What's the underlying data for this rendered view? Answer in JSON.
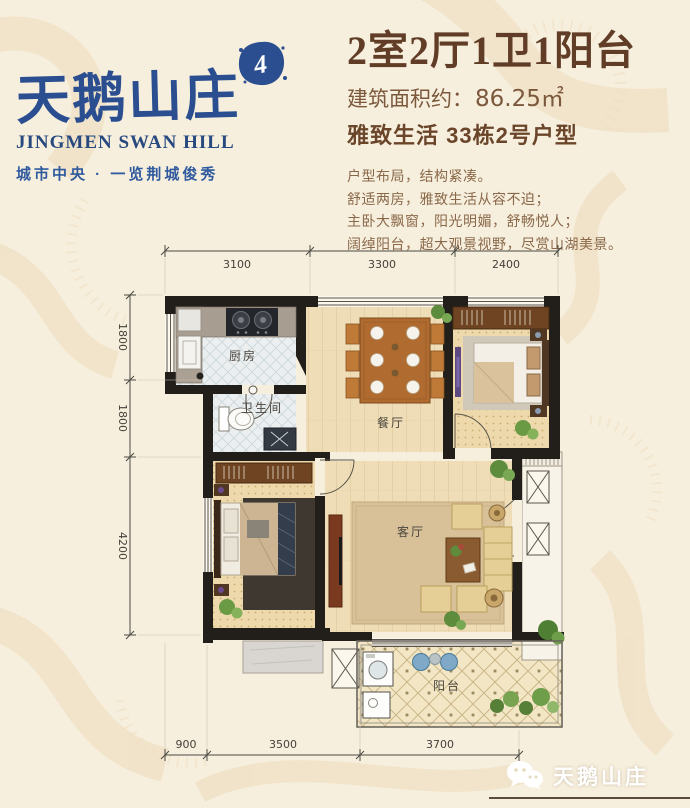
{
  "logo": {
    "brand": "天鹅山庄",
    "subtitle": "JINGMEN SWAN HILL",
    "tagline": "城市中央 · 一览荆城俊秀",
    "badge": "4"
  },
  "header": {
    "title": "2室2厅1卫1阳台",
    "area_label": "建筑面积约：",
    "area_value": "86.25㎡",
    "unit_line": "雅致生活  33栋2号户型",
    "desc": [
      "户型布局，结构紧凑。",
      "舒适两房，雅致生活从容不迫；",
      "主卧大飘窗，阳光明媚，舒畅悦人；",
      "阔绰阳台，超大观景视野，尽赏山湖美景。"
    ]
  },
  "floorplan": {
    "room_labels": {
      "kitchen": "厨房",
      "bathroom": "卫生间",
      "dining": "餐厅",
      "living": "客厅",
      "balcony": "阳台"
    },
    "dims_top": [
      "3100",
      "3300",
      "2400"
    ],
    "dims_left": [
      "1800",
      "1800",
      "4200"
    ],
    "dims_bottom": [
      "900",
      "3500",
      "3700"
    ]
  },
  "footer": {
    "watermark": "天鹅山庄"
  },
  "colors": {
    "brand_blue": "#2a4e8f",
    "title_brown": "#613d27",
    "text_brown": "#8a684a",
    "wall_black": "#221e1a",
    "background": "#f7efdd"
  }
}
